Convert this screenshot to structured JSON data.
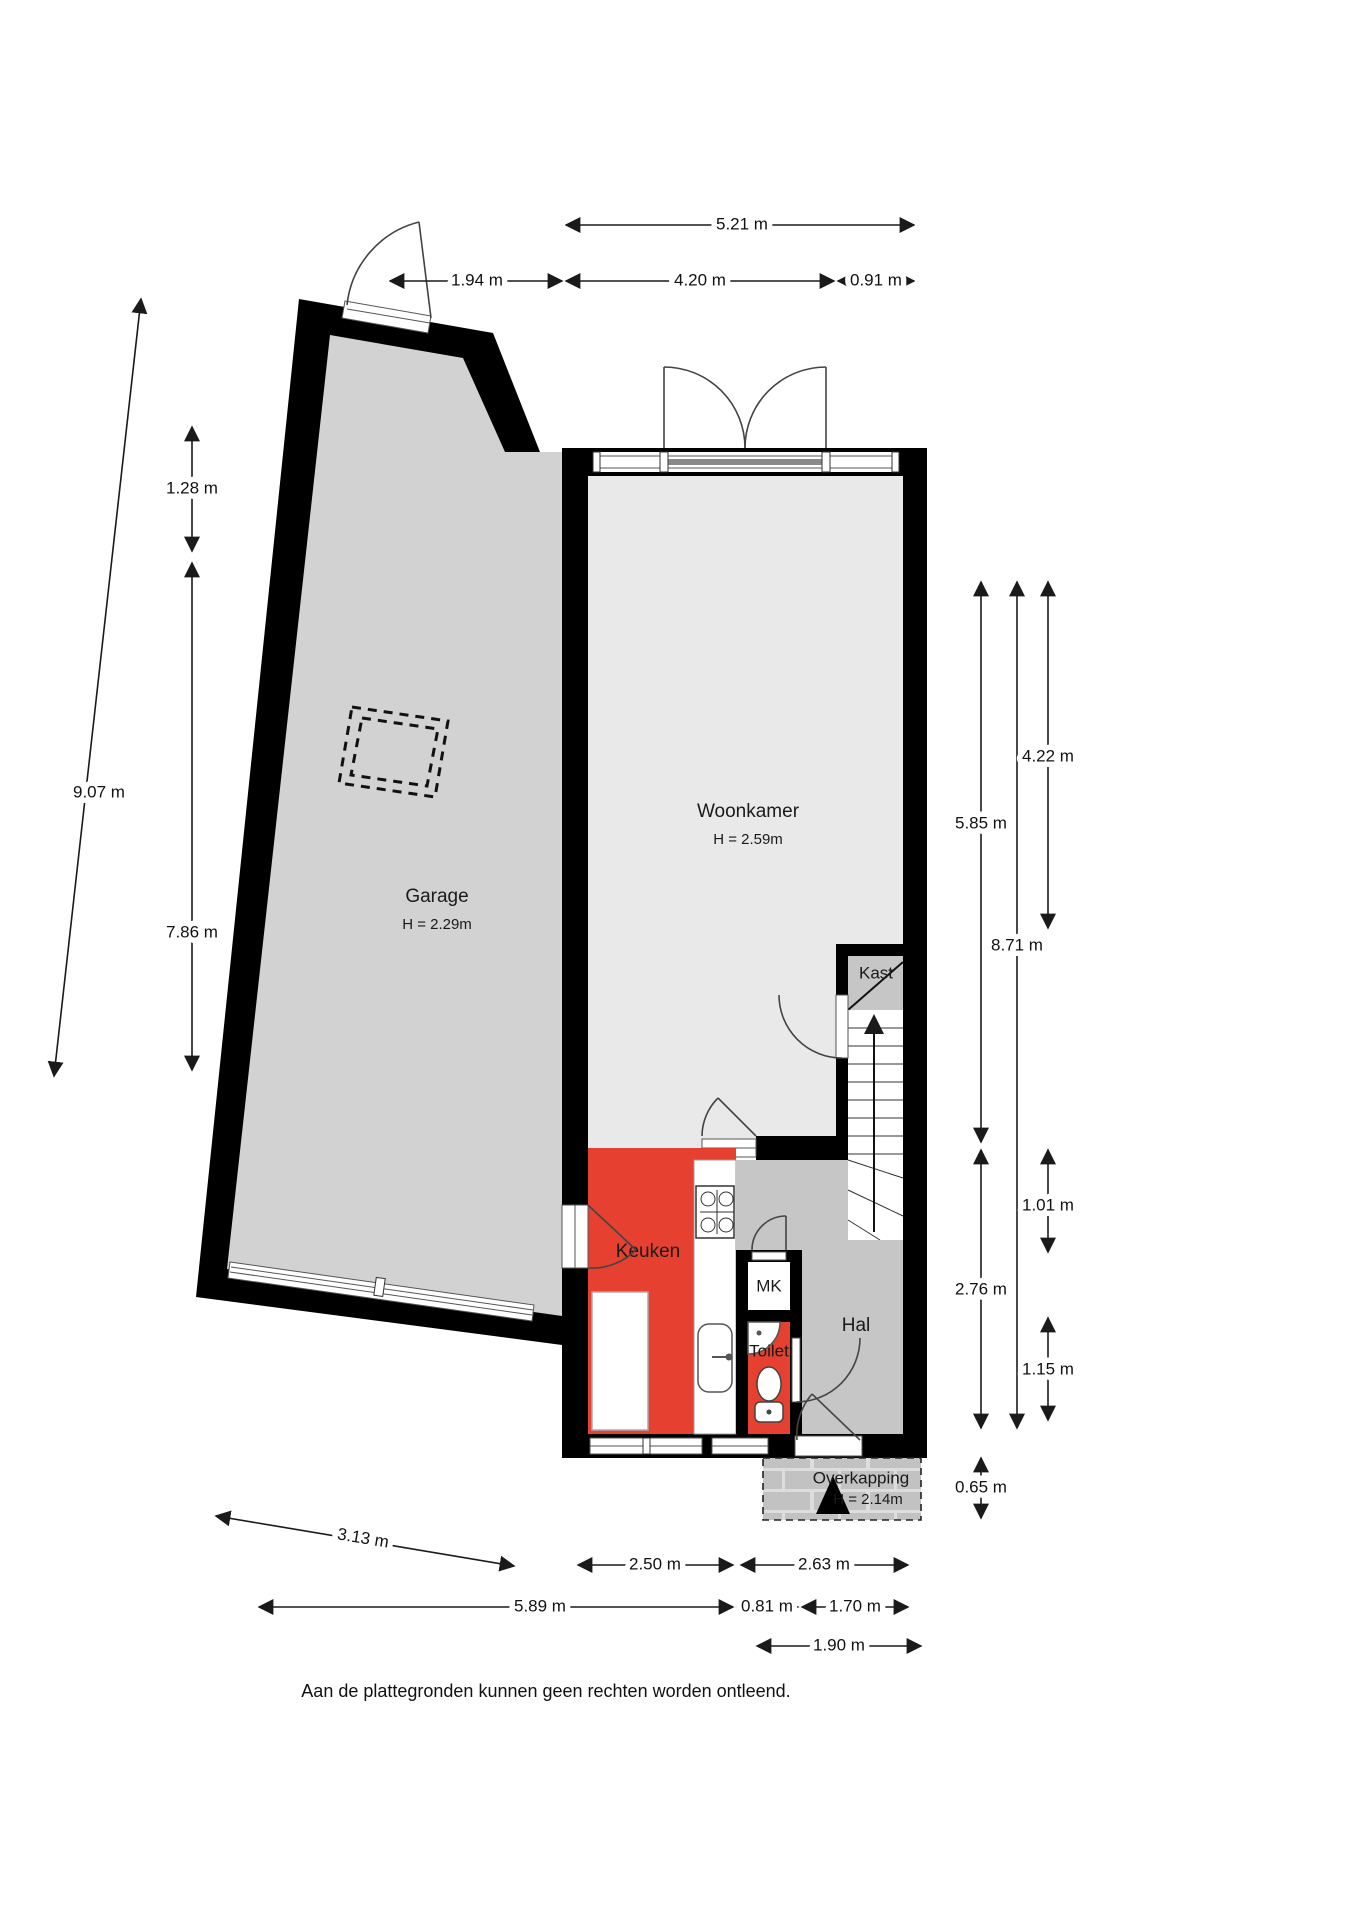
{
  "title": "Begane grond plattegrond",
  "rooms": {
    "garage": {
      "label": "Garage",
      "height": "H = 2.29m"
    },
    "woonkamer": {
      "label": "Woonkamer",
      "height": "H = 2.59m"
    },
    "keuken": {
      "label": "Keuken"
    },
    "mk": {
      "label": "MK"
    },
    "toilet": {
      "label": "Toilet"
    },
    "hal": {
      "label": "Hal"
    },
    "kast": {
      "label": "Kast"
    },
    "overkapping": {
      "label": "Overkapping",
      "height": "H = 2.14m"
    }
  },
  "dimensions": {
    "top": [
      {
        "label": "5.21 m"
      },
      {
        "label": "1.94 m"
      },
      {
        "label": "4.20 m"
      },
      {
        "label": "0.91 m"
      }
    ],
    "left": [
      {
        "label": "9.07 m"
      },
      {
        "label": "1.28 m"
      },
      {
        "label": "7.86 m"
      }
    ],
    "right": [
      {
        "label": "5.85 m"
      },
      {
        "label": "8.71 m"
      },
      {
        "label": "4.22 m"
      },
      {
        "label": "2.76 m"
      },
      {
        "label": "1.01 m"
      },
      {
        "label": "1.15 m"
      },
      {
        "label": "0.65 m"
      }
    ],
    "bottom": [
      {
        "label": "3.13 m"
      },
      {
        "label": "2.50 m"
      },
      {
        "label": "2.63 m"
      },
      {
        "label": "5.89 m"
      },
      {
        "label": "0.81 m"
      },
      {
        "label": "1.70 m"
      },
      {
        "label": "1.90 m"
      }
    ]
  },
  "footer": {
    "disclaimer": "Aan de plattegronden kunnen geen rechten worden ontleend."
  },
  "colors": {
    "wall": "#000000",
    "woonkamer_fill": "#e9e9e9",
    "garage_fill": "#d2d2d2",
    "hal_fill": "#c6c6c6",
    "accent_red": "#e64130",
    "overkapping_fill": "#c3c2c2"
  }
}
